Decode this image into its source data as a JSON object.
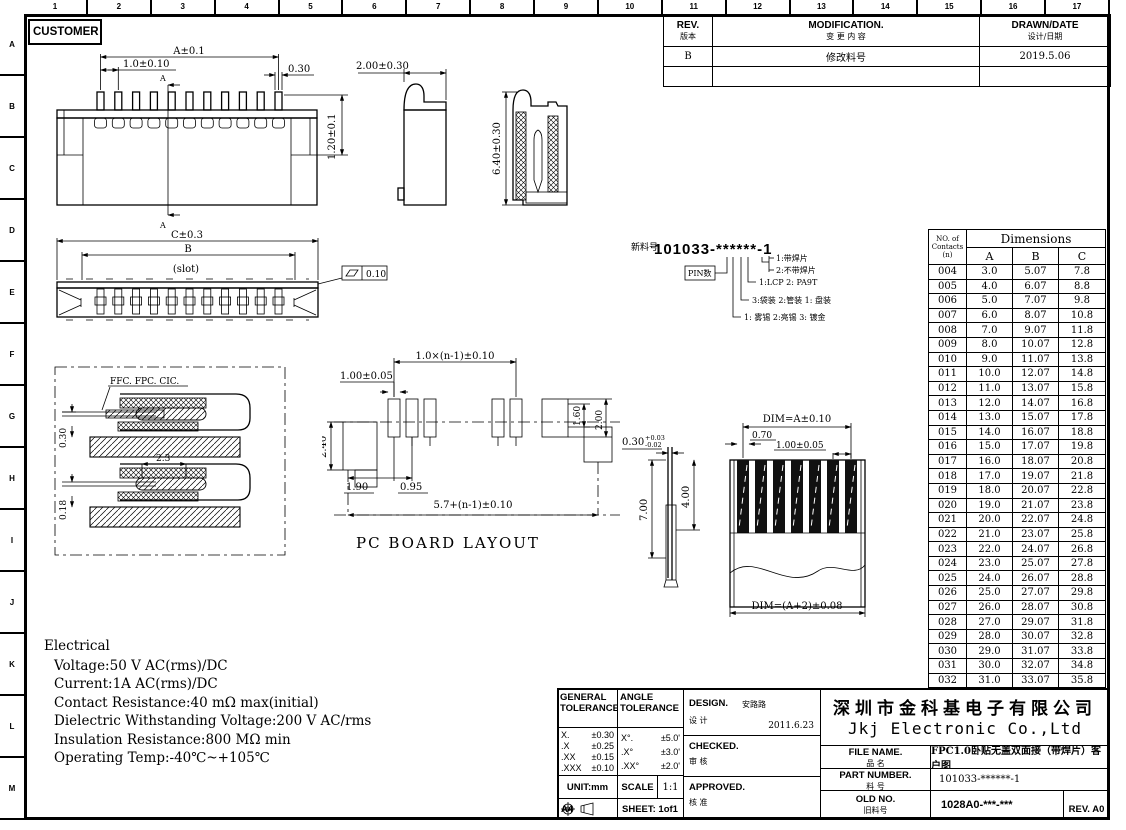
{
  "frame": {
    "top_ruler": [
      "1",
      "2",
      "3",
      "4",
      "5",
      "6",
      "7",
      "8",
      "9",
      "10",
      "11",
      "12",
      "13",
      "14",
      "15",
      "16",
      "17"
    ],
    "left_ruler": [
      "A",
      "B",
      "C",
      "D",
      "E",
      "F",
      "G",
      "H",
      "I",
      "J",
      "K",
      "L",
      "M"
    ]
  },
  "customer": {
    "label": "CUSTOMER"
  },
  "rev_table": {
    "col_rev_en": "REV.",
    "col_rev_cn": "版本",
    "col_mod_en": "MODIFICATION.",
    "col_mod_cn": "变 更 内 容",
    "col_drawn_en": "DRAWN/DATE",
    "col_drawn_cn": "设计/日期",
    "rows": [
      {
        "rev": "B",
        "mod": "修改料号",
        "date": "2019.5.06"
      },
      {
        "rev": "",
        "mod": "",
        "date": ""
      }
    ]
  },
  "part_code": {
    "prefix_label": "新料号",
    "number": "101033-******-1",
    "pin_label": "PIN数",
    "notes": [
      "1:带焊片",
      "2:不带焊片",
      "1:LCP  2: PA9T",
      "3:袋装   2:管装   1: 盘装",
      "1: 雾锡  2:亮锡 3: 镀金"
    ]
  },
  "dims": {
    "front": {
      "a": "A±0.1",
      "pitch": "1.0±0.10",
      "pin": "0.30",
      "height": "1.20±0.1",
      "section": "A"
    },
    "side": {
      "w": "2.00±0.30"
    },
    "section": {
      "h": "6.40±0.30"
    },
    "bottom": {
      "c": "C±0.3",
      "b": "B",
      "slot": "(slot)",
      "flat": "0.10"
    },
    "detail": {
      "cables": "FFC. FPC. CIC.",
      "t1": "0.30",
      "w": "2.3",
      "t2": "0.18"
    },
    "pcb": {
      "pitch": "1.0×(n-1)±0.10",
      "pad": "1.00±0.05",
      "h1": "1.60",
      "h2": "2.00",
      "h3": "2.40",
      "o1": "1.90",
      "o2": "0.95",
      "total": "5.7+(n-1)±0.10",
      "caption": "PC BOARD LAYOUT"
    },
    "ffc": {
      "t": "0.30",
      "tp": "+0.03",
      "tm": "-0.02",
      "l1": "7.00",
      "l2": "4.00",
      "wa": "DIM=A±0.10",
      "gap": "0.70",
      "pitch": "1.00±0.05",
      "wb": "DIM=(A+2)±0.08"
    }
  },
  "dim_table": {
    "h_contacts_1": "NO. of",
    "h_contacts_2": "Contacts",
    "h_contacts_3": "(n)",
    "h_dimensions": "Dimensions",
    "columns": [
      "A",
      "B",
      "C"
    ],
    "rows": [
      [
        "004",
        "3.0",
        "5.07",
        "7.8"
      ],
      [
        "005",
        "4.0",
        "6.07",
        "8.8"
      ],
      [
        "006",
        "5.0",
        "7.07",
        "9.8"
      ],
      [
        "007",
        "6.0",
        "8.07",
        "10.8"
      ],
      [
        "008",
        "7.0",
        "9.07",
        "11.8"
      ],
      [
        "009",
        "8.0",
        "10.07",
        "12.8"
      ],
      [
        "010",
        "9.0",
        "11.07",
        "13.8"
      ],
      [
        "011",
        "10.0",
        "12.07",
        "14.8"
      ],
      [
        "012",
        "11.0",
        "13.07",
        "15.8"
      ],
      [
        "013",
        "12.0",
        "14.07",
        "16.8"
      ],
      [
        "014",
        "13.0",
        "15.07",
        "17.8"
      ],
      [
        "015",
        "14.0",
        "16.07",
        "18.8"
      ],
      [
        "016",
        "15.0",
        "17.07",
        "19.8"
      ],
      [
        "017",
        "16.0",
        "18.07",
        "20.8"
      ],
      [
        "018",
        "17.0",
        "19.07",
        "21.8"
      ],
      [
        "019",
        "18.0",
        "20.07",
        "22.8"
      ],
      [
        "020",
        "19.0",
        "21.07",
        "23.8"
      ],
      [
        "021",
        "20.0",
        "22.07",
        "24.8"
      ],
      [
        "022",
        "21.0",
        "23.07",
        "25.8"
      ],
      [
        "023",
        "22.0",
        "24.07",
        "26.8"
      ],
      [
        "024",
        "23.0",
        "25.07",
        "27.8"
      ],
      [
        "025",
        "24.0",
        "26.07",
        "28.8"
      ],
      [
        "026",
        "25.0",
        "27.07",
        "29.8"
      ],
      [
        "027",
        "26.0",
        "28.07",
        "30.8"
      ],
      [
        "028",
        "27.0",
        "29.07",
        "31.8"
      ],
      [
        "029",
        "28.0",
        "30.07",
        "32.8"
      ],
      [
        "030",
        "29.0",
        "31.07",
        "33.8"
      ],
      [
        "031",
        "30.0",
        "32.07",
        "34.8"
      ],
      [
        "032",
        "31.0",
        "33.07",
        "35.8"
      ]
    ]
  },
  "electrical": {
    "title": "Electrical",
    "lines": [
      "Voltage:50 V AC(rms)/DC",
      "Current:1A AC(rms)/DC",
      "Contact Resistance:40 mΩ max(initial)",
      "Dielectric Withstanding Voltage:200 V AC/rms",
      "Insulation Resistance:800 MΩ min",
      "Operating Temp:-40℃~+105℃"
    ]
  },
  "title_block": {
    "general": {
      "l1": "GENERAL",
      "l2": "TOLERANCE",
      "rows": [
        {
          "k": "X.",
          "v": "±0.30"
        },
        {
          "k": ".X",
          "v": "±0.25"
        },
        {
          "k": ".XX",
          "v": "±0.15"
        },
        {
          "k": ".XXX",
          "v": "±0.10"
        }
      ]
    },
    "angle": {
      "l1": "ANGLE",
      "l2": "TOLERANCE",
      "rows": [
        {
          "k": "X°.",
          "v": "±5.0'"
        },
        {
          "k": ".X°",
          "v": "±3.0'"
        },
        {
          "k": ".XX°",
          "v": "±2.0'"
        }
      ]
    },
    "design": {
      "en": "DESIGN.",
      "cn": "设 计",
      "name": "安路路",
      "date": "2011.6.23"
    },
    "checked": {
      "en": "CHECKED.",
      "cn": "审 核"
    },
    "approved": {
      "en": "APPROVED.",
      "cn": "核 准"
    },
    "unit": "UNIT:mm",
    "scale_label": "SCALE",
    "scale_value": "1:1",
    "paper": "A4",
    "sheet": "SHEET: 1of1",
    "company_cn": "深圳市金科基电子有限公司",
    "company_en": "Jkj Electronic Co.,Ltd",
    "file_name": {
      "en": "FILE NAME.",
      "cn": "品 名",
      "value": "FPC1.0卧贴无盖双面接（带焊片）客户图"
    },
    "part_number": {
      "en": "PART NUMBER.",
      "cn": "料 号",
      "value": "101033-******-1"
    },
    "old_no": {
      "en": "OLD NO.",
      "cn": "旧料号",
      "value": "1028A0-***-***"
    },
    "rev": "REV. A0"
  }
}
